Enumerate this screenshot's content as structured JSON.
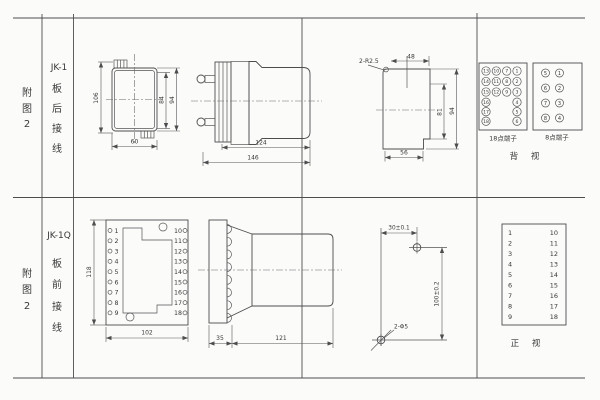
{
  "colors": {
    "line": "#4d4d4d",
    "text": "#383838",
    "background": "#fbfbfa"
  },
  "row1": {
    "fig_label": [
      "附",
      "图",
      "2"
    ],
    "model": "JK-1",
    "wiring": [
      "板",
      "后",
      "接",
      "线"
    ],
    "rear_view": {
      "dim_total_height": "106",
      "dim_inner_height": "84",
      "dim_case_height": "94",
      "dim_width": "60"
    },
    "side_view": {
      "dim_case_length": "124",
      "dim_total_length": "146"
    },
    "cutout_view": {
      "corner_radius": "2-R2.5",
      "dim_top_width": "48",
      "dim_inner_height": "81",
      "dim_height": "94",
      "dim_width": "56"
    },
    "terminal18": {
      "label": "18点端子",
      "grid": [
        [
          "13",
          "10",
          "7",
          "1"
        ],
        [
          "14",
          "11",
          "8",
          "2"
        ],
        [
          "15",
          "12",
          "9",
          "3"
        ]
      ],
      "left": [
        "16",
        "17",
        "18"
      ],
      "right": [
        "4",
        "5",
        "6"
      ]
    },
    "terminal8": {
      "label": "8点端子",
      "left": [
        "5",
        "6",
        "7",
        "8"
      ],
      "right": [
        "1",
        "2",
        "3",
        "4"
      ]
    },
    "view_label": "背 视"
  },
  "row2": {
    "fig_label": [
      "附",
      "图",
      "2"
    ],
    "model": "JK-1Q",
    "wiring": [
      "板",
      "前",
      "接",
      "线"
    ],
    "front_view": {
      "left_terminals": [
        "1",
        "2",
        "3",
        "4",
        "5",
        "6",
        "7",
        "8",
        "9"
      ],
      "right_terminals": [
        "10",
        "11",
        "12",
        "13",
        "14",
        "15",
        "16",
        "17",
        "18"
      ],
      "dim_height": "118",
      "dim_width": "102"
    },
    "side_view": {
      "dim_flange": "35",
      "dim_body": "121"
    },
    "drill_view": {
      "dim_horizontal": "30±0.1",
      "dim_vertical": "100±0.2",
      "hole_note": "2-Φ5"
    },
    "table": {
      "left": [
        "1",
        "2",
        "3",
        "4",
        "5",
        "6",
        "7",
        "8",
        "9"
      ],
      "right": [
        "10",
        "11",
        "12",
        "13",
        "14",
        "15",
        "16",
        "17",
        "18"
      ],
      "view_label": "正 视"
    }
  }
}
